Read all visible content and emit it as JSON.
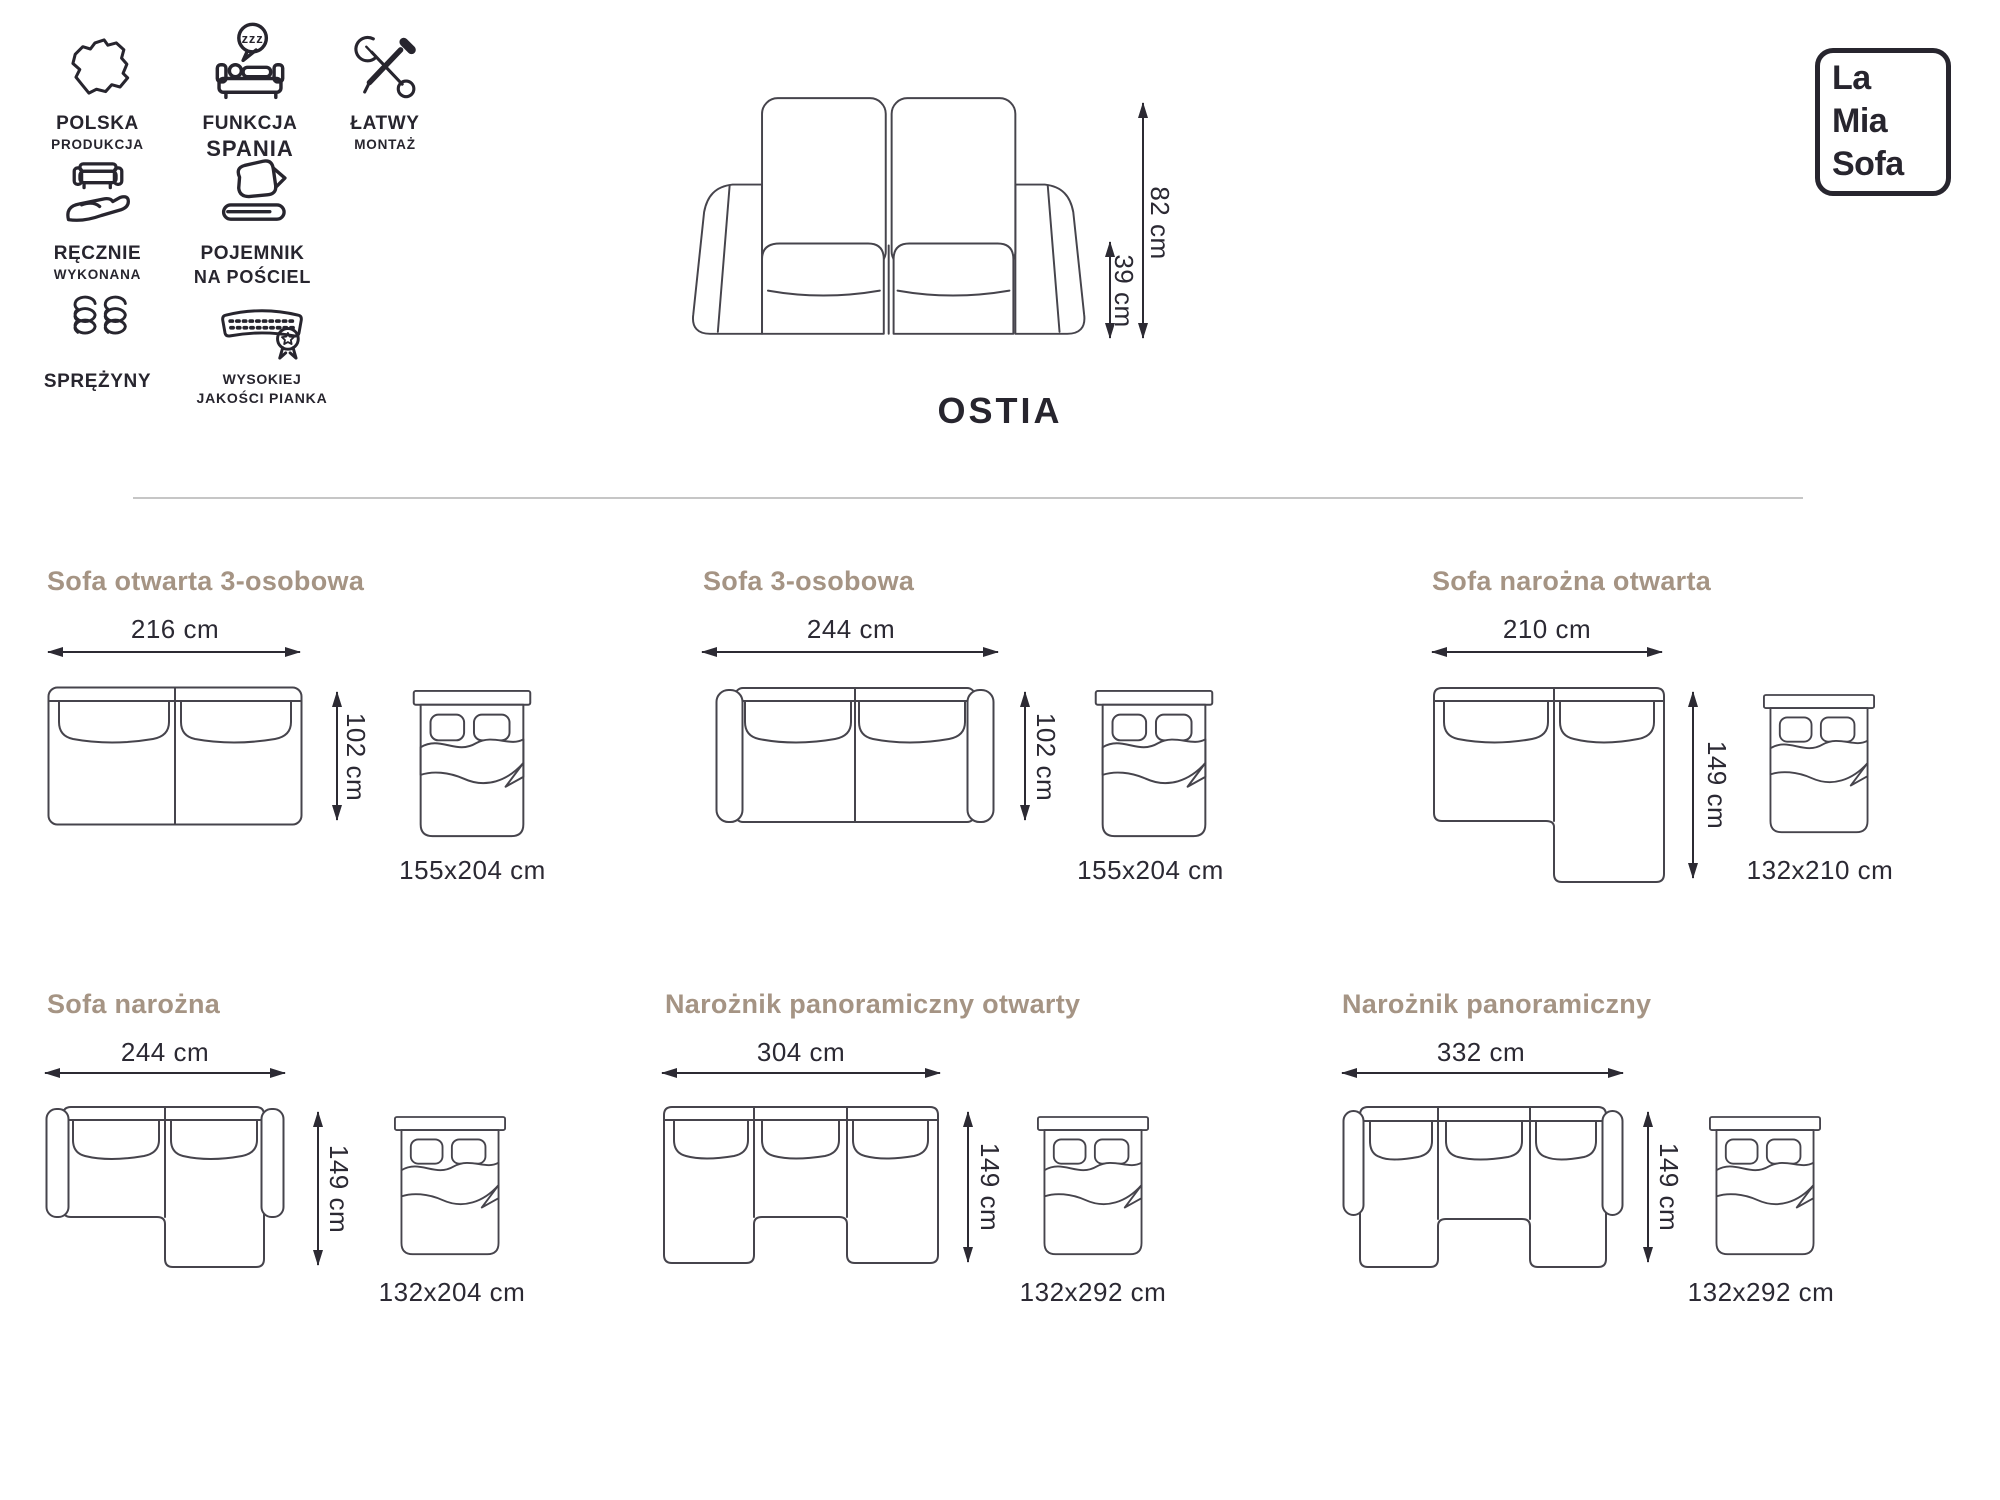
{
  "colors": {
    "accent": "#a59484",
    "ink": "#27252e",
    "line_art": "#46444c",
    "divider": "#c6c6c6"
  },
  "brand": {
    "line1": "La",
    "line2": "Mia",
    "line3": "Sofa"
  },
  "product": {
    "name": "OSTIA",
    "height": "82 cm",
    "seat_height": "39 cm"
  },
  "features": [
    {
      "line1": "POLSKA",
      "line2": "PRODUKCJA",
      "icon": "poland-map-icon"
    },
    {
      "line1": "FUNKCJA",
      "line2": "SPANIA",
      "icon": "sleep-function-icon",
      "bubble": "zzz"
    },
    {
      "line1": "ŁATWY",
      "line2": "MONTAŻ",
      "icon": "tools-icon"
    },
    {
      "line1": "RĘCZNIE",
      "line2": "WYKONANA",
      "icon": "hand-sofa-icon"
    },
    {
      "line1": "POJEMNIK",
      "line2": "NA POŚCIEL",
      "icon": "bedding-storage-icon"
    },
    {
      "line1": "SPRĘŻYNY",
      "line2": "",
      "icon": "springs-icon"
    },
    {
      "line1": "WYSOKIEJ",
      "line2": "JAKOŚCI PIANKA",
      "icon": "foam-quality-icon"
    }
  ],
  "configs": [
    {
      "title": "Sofa otwarta 3-osobowa",
      "width": "216 cm",
      "depth": "102 cm",
      "bed_size": "155x204 cm"
    },
    {
      "title": "Sofa 3-osobowa",
      "width": "244 cm",
      "depth": "102 cm",
      "bed_size": "155x204 cm"
    },
    {
      "title": "Sofa narożna otwarta",
      "width": "210 cm",
      "depth": "149 cm",
      "bed_size": "132x210 cm"
    },
    {
      "title": "Sofa narożna",
      "width": "244 cm",
      "depth": "149 cm",
      "bed_size": "132x204 cm"
    },
    {
      "title": "Narożnik panoramiczny otwarty",
      "width": "304 cm",
      "depth": "149 cm",
      "bed_size": "132x292 cm"
    },
    {
      "title": "Narożnik panoramiczny",
      "width": "332 cm",
      "depth": "149 cm",
      "bed_size": "132x292 cm"
    }
  ]
}
